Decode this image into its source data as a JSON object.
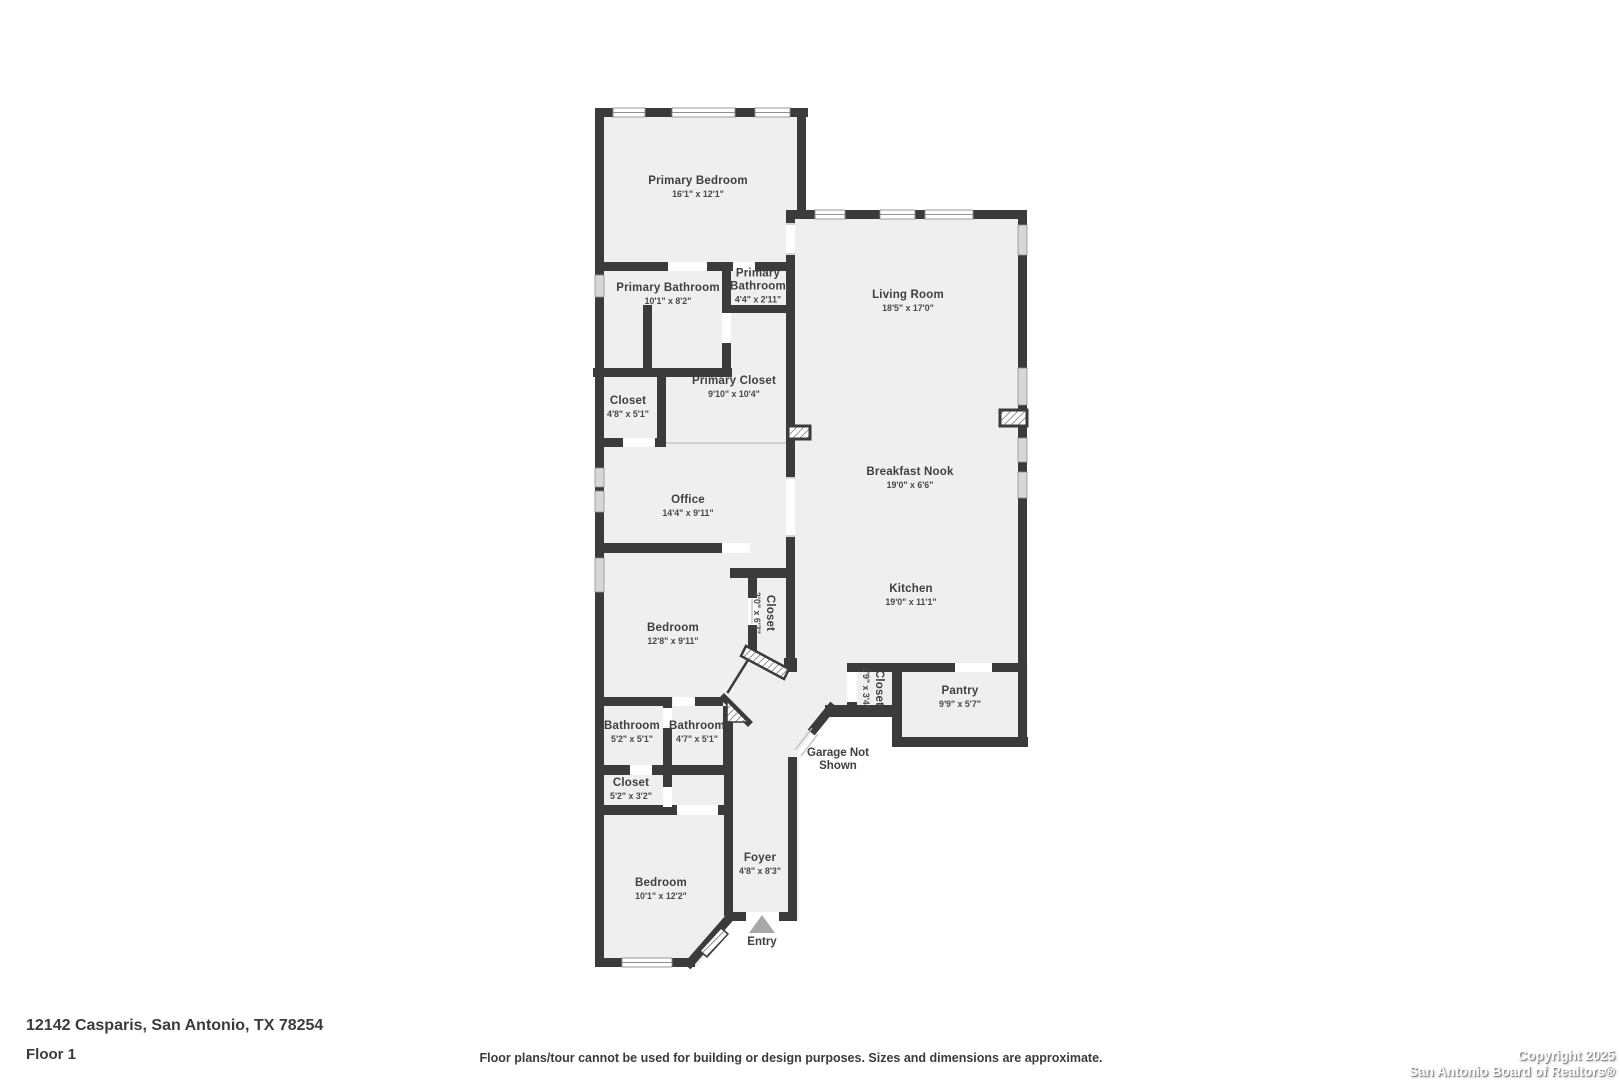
{
  "colors": {
    "wall": "#3b3b3b",
    "floor": "#f0efef",
    "text": "#3f3f3f",
    "entry_arrow": "#a8a8a8"
  },
  "rooms": [
    {
      "name": "Primary Bedroom",
      "dims": "16'1\" x 12'1\""
    },
    {
      "name": "Primary Bathroom",
      "dims": "10'1\" x 8'2\""
    },
    {
      "name": "Primary Bathroom",
      "dims": "4'4\" x 2'11\""
    },
    {
      "name": "Living Room",
      "dims": "18'5\" x 17'0\""
    },
    {
      "name": "Primary Closet",
      "dims": "9'10\" x 10'4\""
    },
    {
      "name": "Closet",
      "dims": "4'8\" x 5'1\""
    },
    {
      "name": "Office",
      "dims": "14'4\" x 9'11\""
    },
    {
      "name": "Breakfast Nook",
      "dims": "19'0\" x 6'6\""
    },
    {
      "name": "Kitchen",
      "dims": "19'0\" x 11'1\""
    },
    {
      "name": "Bedroom",
      "dims": "12'8\" x 9'11\""
    },
    {
      "name": "Closet",
      "dims": "2'0\" x 6'7\""
    },
    {
      "name": "Closet",
      "dims": "2'9\" x 3'4\""
    },
    {
      "name": "Pantry",
      "dims": "9'9\" x 5'7\""
    },
    {
      "name": "Bathroom",
      "dims": "5'2\" x 5'1\""
    },
    {
      "name": "Bathroom",
      "dims": "4'7\" x 5'1\""
    },
    {
      "name": "Closet",
      "dims": "5'2\" x 3'2\""
    },
    {
      "name": "Bedroom",
      "dims": "10'1\" x 12'2\""
    },
    {
      "name": "Foyer",
      "dims": "4'8\" x 8'3\""
    }
  ],
  "annotations": {
    "garage_note": "Garage Not Shown",
    "entry": "Entry"
  },
  "footer": {
    "address": "12142 Casparis, San Antonio, TX 78254",
    "floor": "Floor 1",
    "disclaimer": "Floor plans/tour cannot be used for building or design purposes. Sizes and dimensions are approximate.",
    "copyright_line1": "Copyright 2025",
    "copyright_line2": "San Antonio Board of Realtors®"
  }
}
